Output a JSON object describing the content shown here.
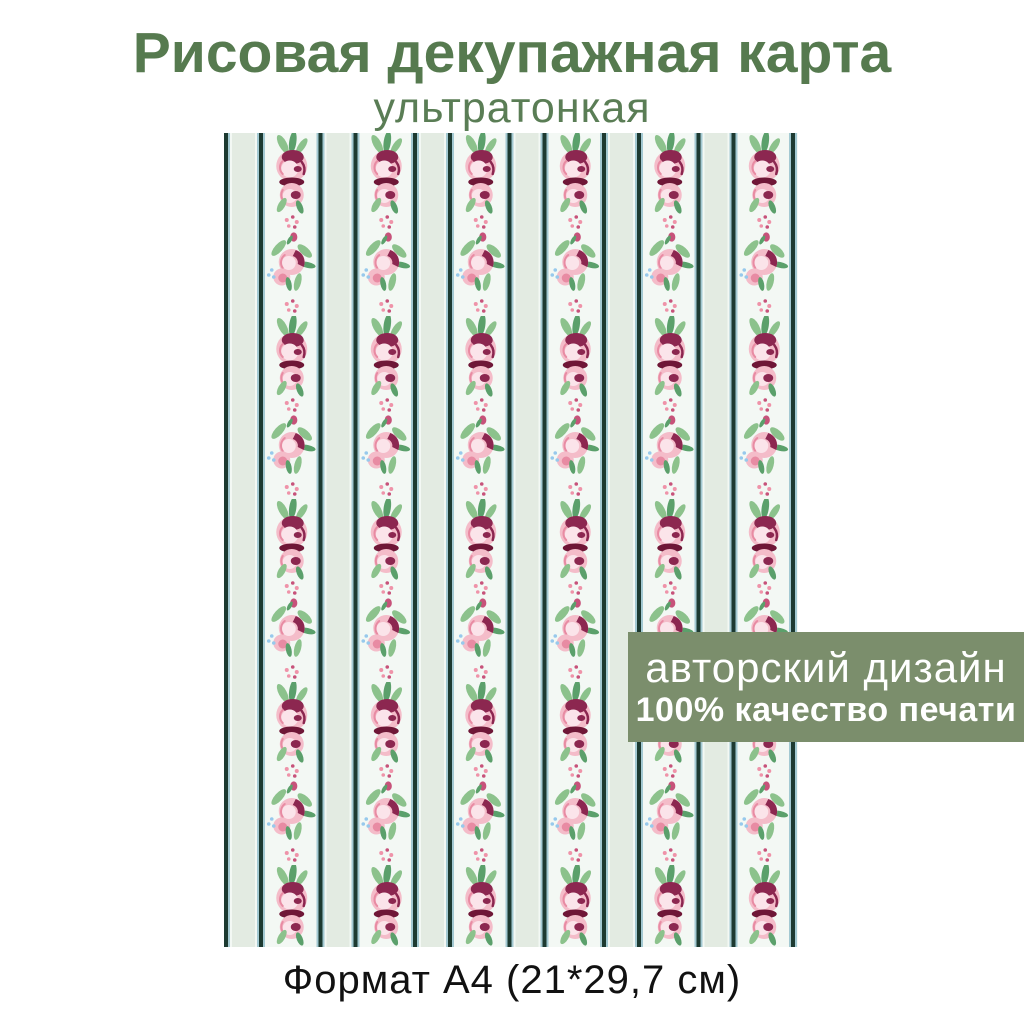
{
  "header": {
    "title": "Рисовая декупажная карта",
    "subtitle": "ультратонкая"
  },
  "badge": {
    "line1": "авторский дизайн",
    "line2": "100% качество печати"
  },
  "footer": {
    "format_label": "Формат А4 (21*29,7 см)"
  },
  "preview": {
    "kind": "a4-sheet-pattern",
    "pattern": "vertical stripes with rose garland columns",
    "rose_columns": 6
  },
  "colors": {
    "title_green": "#567a4f",
    "subtitle_green": "#5a7d55",
    "badge_bg": "#7b8e6c",
    "badge_text": "#ffffff",
    "footer_text": "#111111",
    "page_bg": "#ffffff",
    "sheet_bg": "#f3f8f4",
    "stripe_dark": "#1d3a31",
    "stripe_blue": "#a3c9d2",
    "stripe_green": "#e3ebe2",
    "leaf": "#8cc28c",
    "leaf_dark": "#5ba06b",
    "rose_pink": "#f4bcc9",
    "rose_pink_mid": "#e88ba3",
    "rose_highlight": "#fbe4ea",
    "rose_dark": "#8c2750",
    "rose_deep": "#6f1737",
    "dot_pink": "#ef93a9",
    "dot_deep": "#c7527a",
    "dot_blue": "#97c9ec"
  }
}
